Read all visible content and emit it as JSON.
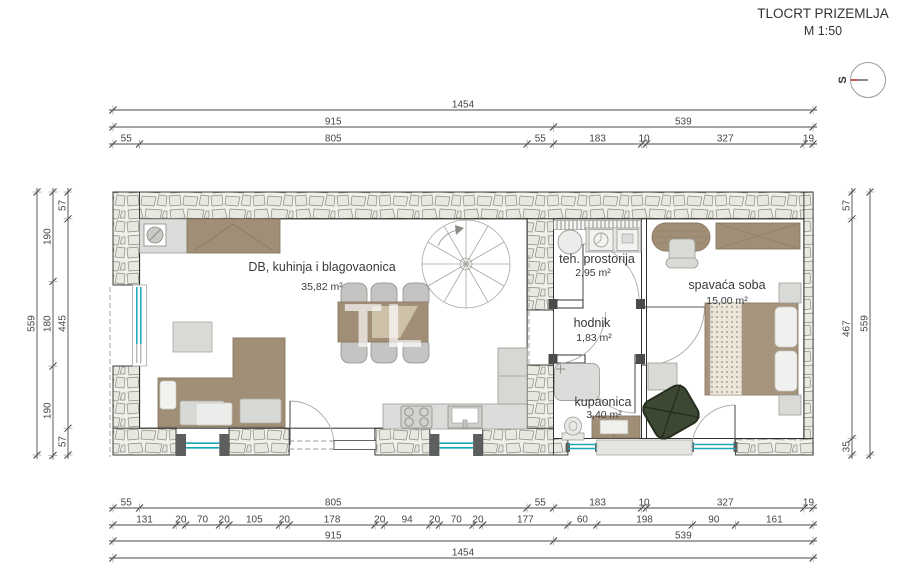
{
  "title": {
    "name": "TLOCRT PRIZEMLJA",
    "scale": "M 1:50"
  },
  "compass": {
    "direction_label": "S"
  },
  "watermark": {
    "line1": "TL",
    "line2": "REA"
  },
  "rooms": {
    "living": {
      "name": "DB, kuhinja i blagovaonica",
      "area": "35,82 m²"
    },
    "tech": {
      "name": "teh. prostorija",
      "area": "2,95 m²"
    },
    "hall": {
      "name": "hodnik",
      "area": "1,83 m²"
    },
    "bedroom": {
      "name": "spavaća soba",
      "area": "15,00 m²"
    },
    "bathroom": {
      "name": "kupaonica",
      "area": "3,40 m²"
    }
  },
  "dimensions": {
    "top": [
      {
        "values": [
          1454
        ]
      },
      {
        "values": [
          915,
          539
        ]
      },
      {
        "values": [
          55,
          805,
          55,
          183,
          10,
          327,
          19
        ]
      }
    ],
    "bottom": [
      {
        "values": [
          55,
          805,
          55,
          183,
          10,
          327,
          19
        ]
      },
      {
        "values": [
          131,
          20,
          70,
          20,
          105,
          20,
          178,
          20,
          94,
          20,
          70,
          20,
          177,
          60,
          198,
          90,
          161
        ]
      },
      {
        "values": [
          915,
          539
        ]
      },
      {
        "values": [
          1454
        ]
      }
    ],
    "left": [
      {
        "values": [
          57,
          445,
          57
        ]
      },
      {
        "values": [
          190,
          180,
          190
        ]
      },
      {
        "values": [
          559
        ]
      }
    ],
    "right": [
      {
        "values": [
          57,
          467,
          35
        ]
      },
      {
        "values": [
          559
        ]
      }
    ]
  },
  "colors": {
    "window_glass": "#18a7b6",
    "furniture_brown": "#a08e76",
    "armchair_green": "#3d4833",
    "stone_fill": "#f1f0ea",
    "post_dark": "#5d5f5e"
  }
}
